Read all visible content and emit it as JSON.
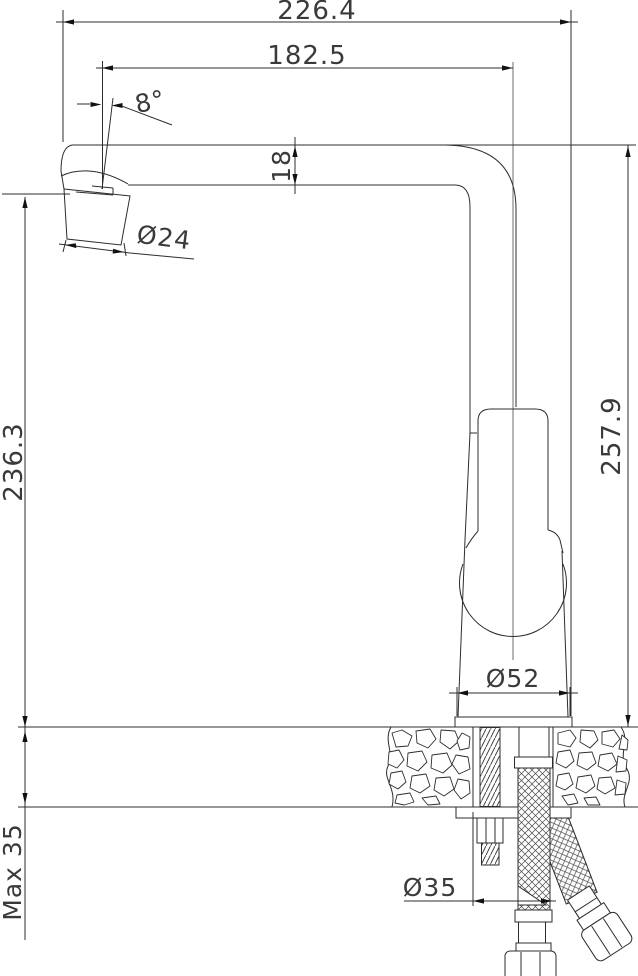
{
  "drawing": {
    "type": "technical dimension drawing",
    "subject": "kitchen faucet side elevation with countertop mounting cross-section",
    "labels": {
      "overall_width": "226.4",
      "spout_reach": "182.5",
      "spout_angle": "8°",
      "spout_tube_height": "18",
      "aerator_diameter": "Ø24",
      "tip_height": "236.3",
      "overall_height": "257.9",
      "base_diameter": "Ø52",
      "hole_diameter": "Ø35",
      "max_counter_thickness": "Max 35"
    }
  }
}
